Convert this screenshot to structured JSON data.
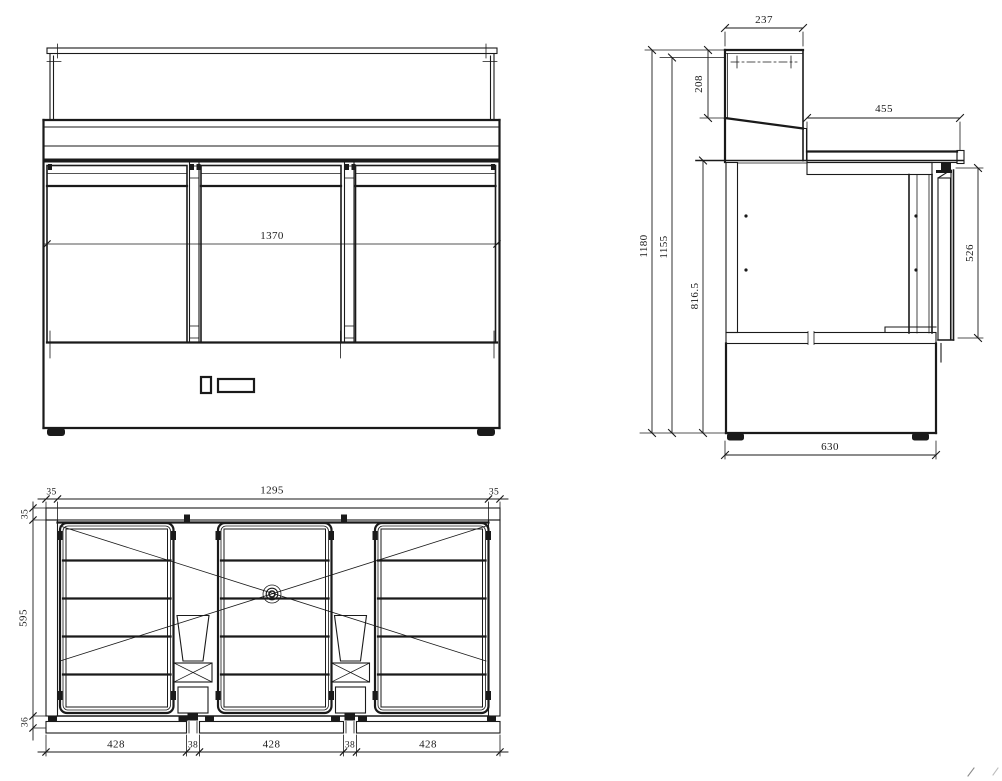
{
  "meta": {
    "background": "#ffffff",
    "ink": "#1a1a1a",
    "drawing_type": "technical-three-view-drawing",
    "subject": "three-door refrigerated saladette counter with glass canopy"
  },
  "front_view": {
    "dim_overall_width": "1370"
  },
  "side_view": {
    "dim_canopy_depth": "237",
    "dim_canopy_height": "208",
    "dim_worktop_depth": "455",
    "dim_overall_height": "1180",
    "dim_height_to_worktop": "1155",
    "dim_height_to_counter": "816.5",
    "dim_door_height": "526",
    "dim_base_depth": "630"
  },
  "plan_view": {
    "dim_side_wall_left": "35",
    "dim_inner_width": "1295",
    "dim_side_wall_right": "35",
    "dim_back_wall": "35",
    "dim_inner_depth": "595",
    "dim_front_rail": "36",
    "dim_bay_widths": [
      "428",
      "38",
      "428",
      "38",
      "428"
    ]
  }
}
